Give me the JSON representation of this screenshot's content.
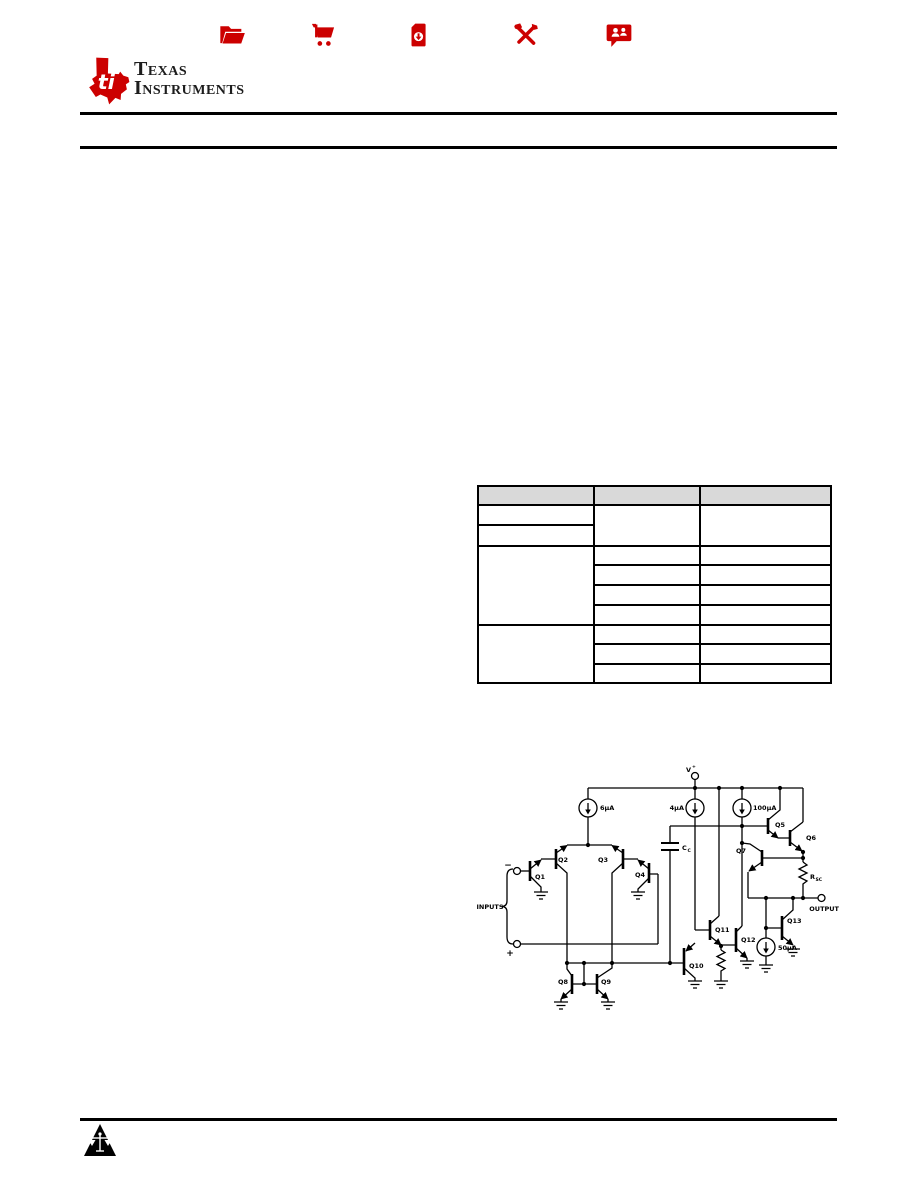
{
  "colors": {
    "ti_red": "#cc0000",
    "table_header_fill": "#d9d9d9",
    "rule_black": "#000000",
    "logo_text_color": "#1d1d1d"
  },
  "header": {
    "logo": {
      "symbol_text": "ti",
      "line1": "Texas",
      "line2": "Instruments"
    },
    "icons": [
      {
        "name": "folder-open-icon"
      },
      {
        "name": "shopping-cart-icon"
      },
      {
        "name": "document-download-icon"
      },
      {
        "name": "tools-icon"
      },
      {
        "name": "support-chat-icon"
      }
    ]
  },
  "table": {
    "columns": 3,
    "header_cells": [
      "",
      "",
      ""
    ],
    "all_cells_blank": true
  },
  "schematic": {
    "labels": {
      "v_main": "V",
      "v_sup": "+",
      "i6": "6µA",
      "i4": "4µA",
      "i100": "100µA",
      "i50": "50µA",
      "q1": "Q1",
      "q2": "Q2",
      "q3": "Q3",
      "q4": "Q4",
      "q5": "Q5",
      "q6": "Q6",
      "q7": "Q7",
      "q8": "Q8",
      "q9": "Q9",
      "q10": "Q10",
      "q11": "Q11",
      "q12": "Q12",
      "q13": "Q13",
      "cc_main": "C",
      "cc_sub": "C",
      "rsc_main": "R",
      "rsc_sub": "SC",
      "inputs": "INPUTS",
      "output": "OUTPUT",
      "minus": "−",
      "plus": "+"
    }
  },
  "footer": {
    "icon": "scales-warning-triangle-icon"
  }
}
